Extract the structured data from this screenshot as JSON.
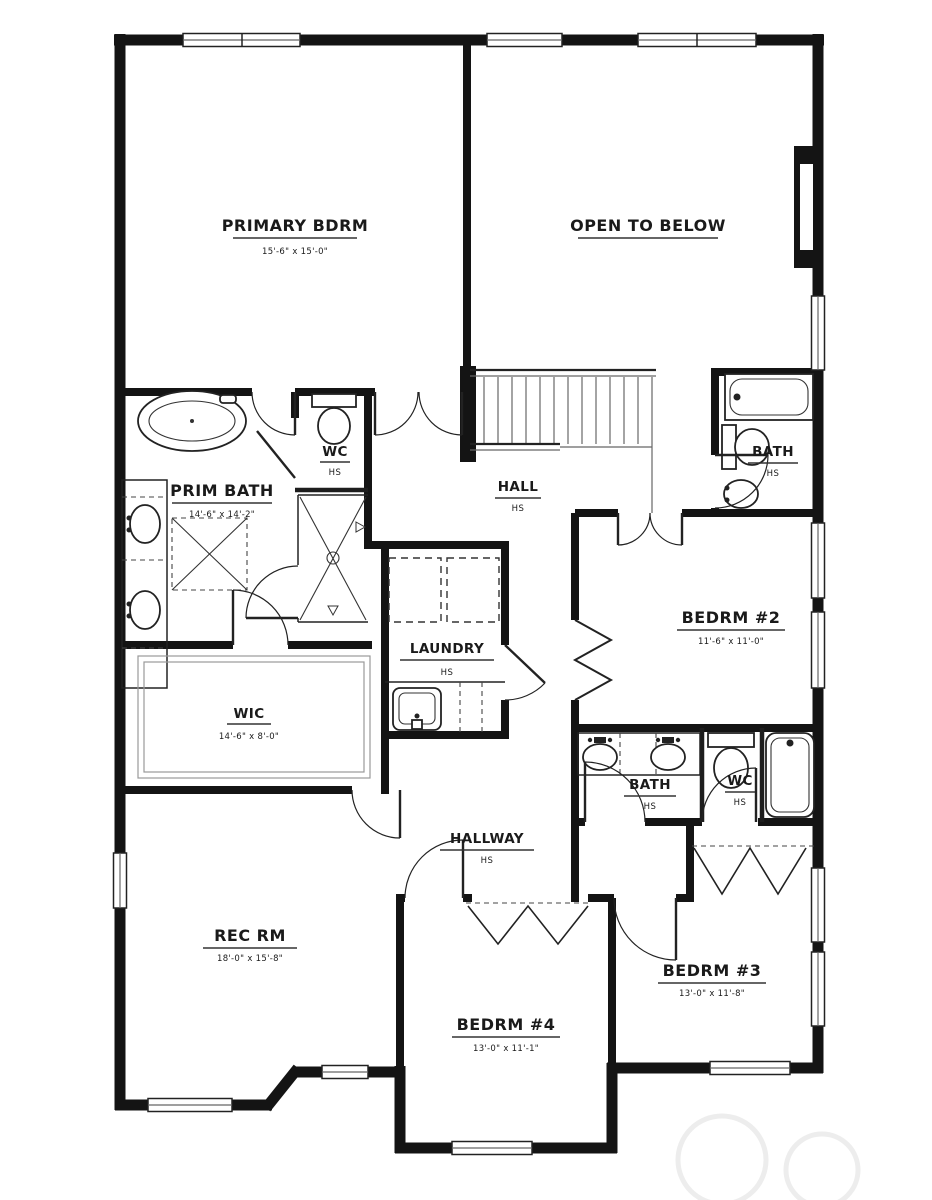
{
  "plan_title": "second floor plan",
  "rooms": {
    "primary_bdrm": {
      "name": "PRIMARY BDRM",
      "dims": "15'-6\" x 15'-0\""
    },
    "open_to_below": {
      "name": "OPEN TO BELOW"
    },
    "prim_bath": {
      "name": "PRIM BATH",
      "dims": "14'-6\" x 14'-2\""
    },
    "wc_top": {
      "name": "WC",
      "note": "HS"
    },
    "hall": {
      "name": "HALL",
      "note": "HS"
    },
    "bath_top": {
      "name": "BATH",
      "note": "HS"
    },
    "bedrm2": {
      "name": "BEDRM #2",
      "dims": "11'-6\" x 11'-0\""
    },
    "laundry": {
      "name": "LAUNDRY",
      "note": "HS"
    },
    "wic": {
      "name": "WIC",
      "dims": "14'-6\" x 8'-0\""
    },
    "bath_mid": {
      "name": "BATH",
      "note": "HS"
    },
    "wc_mid": {
      "name": "WC",
      "note": "HS"
    },
    "hallway": {
      "name": "HALLWAY",
      "note": "HS"
    },
    "rec_rm": {
      "name": "REC RM",
      "dims": "18'-0\" x 15'-8\""
    },
    "bedrm3": {
      "name": "BEDRM #3",
      "dims": "13'-0\" x 11'-8\""
    },
    "bedrm4": {
      "name": "BEDRM #4",
      "dims": "13'-0\" x 11'-1\""
    }
  },
  "colors": {
    "wall": "#141414",
    "line": "#222222",
    "background": "#ffffff",
    "watermark": "#ededed"
  }
}
